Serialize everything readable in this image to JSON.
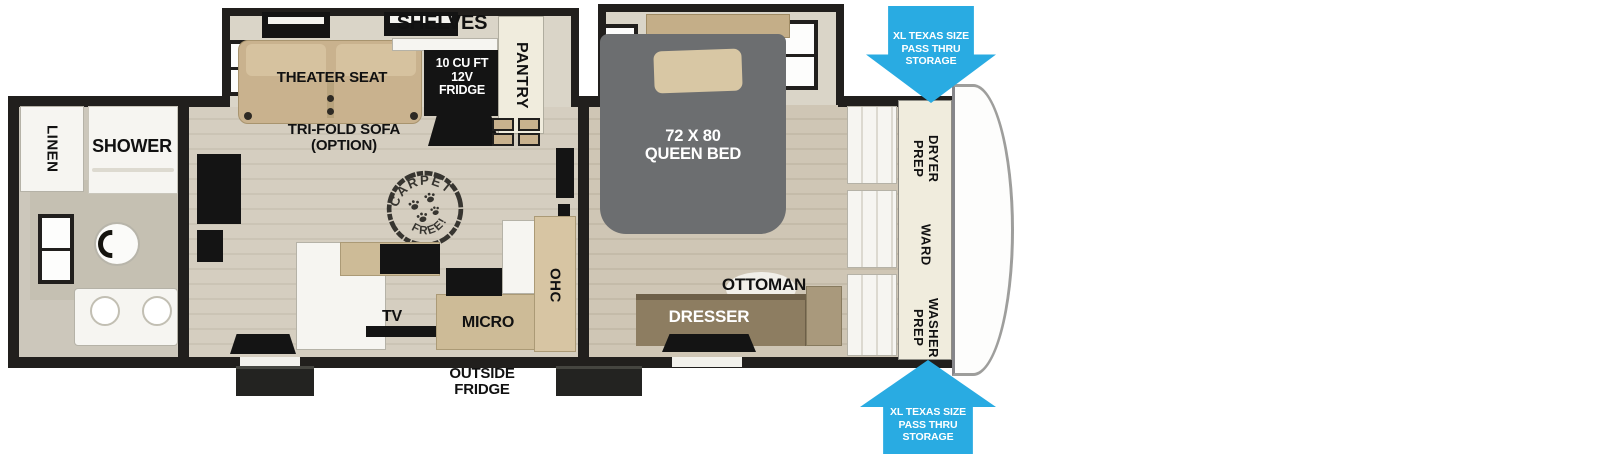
{
  "labels": {
    "linen": "LINEN",
    "shower": "SHOWER",
    "theater_seat": "THEATER SEAT",
    "tri_fold_sofa": "TRI-FOLD SOFA\n(OPTION)",
    "shelves": "SHELVES",
    "fridge": "10 CU FT\n12V\nFRIDGE",
    "pantry": "PANTRY",
    "carpet_stamp_top": "CARPET",
    "carpet_stamp_bottom": "FREE!",
    "tv": "TV",
    "micro": "MICRO",
    "ohc": "OHC",
    "outside_fridge": "OUTSIDE\nFRIDGE",
    "queen_bed": "72 X 80\nQUEEN BED",
    "ottoman": "OTTOMAN",
    "dresser": "DRESSER",
    "dryer_prep": "DRYER\nPREP",
    "ward": "WARD",
    "washer_prep": "WASHER\nPREP",
    "pass_thru_top": "XL TEXAS SIZE\nPASS THRU\nSTORAGE",
    "pass_thru_bottom": "XL TEXAS SIZE\nPASS THRU\nSTORAGE"
  },
  "colors": {
    "wall": "#211f1d",
    "floor_living": "#d5cec0",
    "floor_bed": "#cfc6b5",
    "floor_bath": "#ccc7bb",
    "slide_interior": "#dad5c8",
    "wood_light": "#c9b28e",
    "wood_mid": "#cdbb97",
    "wood_dark": "#8d7d61",
    "bed_gray": "#6c6e70",
    "white_fixture": "#f6f5f1",
    "cream_panel": "#f0ecdd",
    "appliance_black": "#141414",
    "arrow_blue": "#29abe2",
    "label_black": "#111111",
    "label_white": "#ffffff"
  }
}
